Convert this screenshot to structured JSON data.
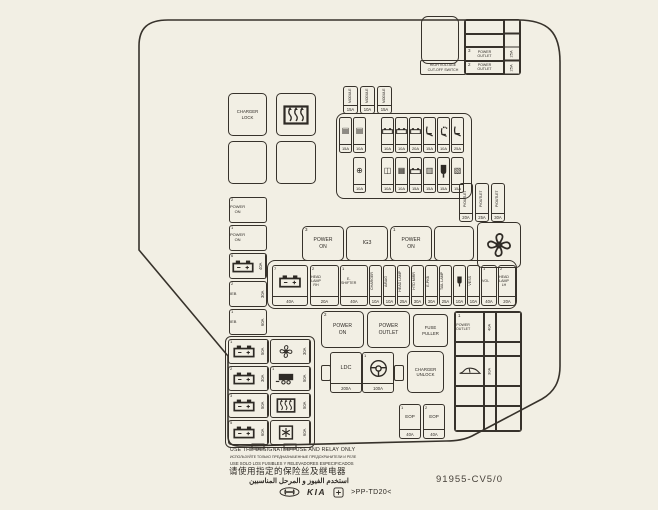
{
  "page": {
    "bg": "#f2efe4",
    "ink": "#2e2a25"
  },
  "hv_switch": {
    "label": "HIGH VOLTAGE\nCUT-OFF SWITCH"
  },
  "top_right_table": {
    "rows": [
      {
        "num": "",
        "label": "",
        "amp": ""
      },
      {
        "num": "",
        "label": "",
        "amp": ""
      },
      {
        "num": "3",
        "label": "POWER\nOUTLET",
        "amp": "25A"
      },
      {
        "num": "2",
        "label": "POWER\nOUTLET",
        "amp": "25A"
      }
    ]
  },
  "boxes": {
    "charger_lock": "CHARGER\nLOCK",
    "power_on_3": {
      "num": "3",
      "label": "POWER\nON"
    },
    "ig3": "IG3",
    "power_on_1": {
      "num": "1",
      "label": "POWER\nON"
    },
    "power_on_2": {
      "num": "2",
      "label": "POWER\nON"
    },
    "power_outlet": "POWER\nOUTLET",
    "fuse_puller": "FUSE\nPULLER",
    "charger_unlock": "CHARGER\nUNLOCK",
    "ldc": {
      "label": "LDC",
      "amp": "200A"
    },
    "steering": {
      "num": "1",
      "amp": "100A"
    }
  },
  "top_trio": [
    {
      "label": "MODULE",
      "amp": "15A"
    },
    {
      "label": "MODULE",
      "amp": "10A"
    },
    {
      "label": "MODULE",
      "amp": "15A"
    }
  ],
  "grid_row_a": [
    {
      "icon": "module",
      "amp": "15A"
    },
    {
      "icon": "module",
      "amp": "10A"
    },
    {
      "cls": "blank"
    },
    {
      "icon": "battsm",
      "amp": "10A"
    },
    {
      "icon": "battsm",
      "amp": "10A"
    },
    {
      "icon": "battsm",
      "amp": "20A"
    },
    {
      "icon": "seat",
      "amp": "15A"
    },
    {
      "icon": "seatfan",
      "amp": "10A"
    },
    {
      "icon": "seat",
      "amp": "25A"
    }
  ],
  "grid_row_b": [
    {
      "cls": "blank"
    },
    {
      "icon": "sensor",
      "amp": "10A"
    },
    {
      "cls": "blank"
    },
    {
      "icon": "mirror",
      "amp": "10A"
    },
    {
      "icon": "grid",
      "amp": "10A"
    },
    {
      "icon": "battsm",
      "amp": "15A"
    },
    {
      "icon": "key",
      "amp": "15A"
    },
    {
      "icon": "plug",
      "amp": "15A"
    },
    {
      "icon": "coil",
      "amp": "15A"
    }
  ],
  "right_trio": [
    {
      "label": "P/OUTLET",
      "amp": "20A"
    },
    {
      "label": "P/OUTLET",
      "amp": "25A"
    },
    {
      "label": "P/OUTLET",
      "amp": "30A"
    }
  ],
  "mid_row": [
    {
      "cls": "wide",
      "num": "7",
      "icon": "batt",
      "amp": "40A",
      "x": 4,
      "y": 4,
      "w": 36,
      "h": 41
    },
    {
      "cls": "wide",
      "num": "2",
      "label": "HEAD\nLAMP\nRH",
      "amp": "20A",
      "x": 42,
      "y": 4,
      "w": 29,
      "h": 41
    },
    {
      "cls": "wide",
      "num": "1",
      "label": "E-\nSHIFTER",
      "amp": "40A",
      "x": 72,
      "y": 4,
      "w": 28,
      "h": 41
    },
    {
      "cls": "narrow",
      "label": "CHARGER",
      "amp": "10A",
      "x": 101,
      "y": 4,
      "w": 13,
      "h": 41
    },
    {
      "cls": "narrow",
      "label": "A/BAG",
      "amp": "10A",
      "x": 115,
      "y": 4,
      "w": 13,
      "h": 41
    },
    {
      "cls": "narrow",
      "label": "HEAD LAMP",
      "amp": "25A",
      "x": 129,
      "y": 4,
      "w": 13,
      "h": 41
    },
    {
      "cls": "narrow",
      "label": "HTD MIRR",
      "amp": "30A",
      "x": 143,
      "y": 4,
      "w": 13,
      "h": 41
    },
    {
      "cls": "narrow",
      "label": "E-PKB",
      "amp": "30A",
      "x": 157,
      "y": 4,
      "w": 13,
      "h": 41
    },
    {
      "cls": "narrow",
      "label": "TAIL LAMP",
      "amp": "25A",
      "x": 171,
      "y": 4,
      "w": 13,
      "h": 41
    },
    {
      "cls": "narrow",
      "icon": "plug",
      "amp": "10A",
      "x": 185,
      "y": 4,
      "w": 13,
      "h": 41
    },
    {
      "cls": "narrow",
      "label": "VESS",
      "amp": "10A",
      "x": 199,
      "y": 4,
      "w": 13,
      "h": 41
    },
    {
      "cls": "wide",
      "num": "1",
      "label": "VOL",
      "amp": "40A",
      "x": 213,
      "y": 4,
      "w": 16,
      "h": 41
    },
    {
      "cls": "wide",
      "num": "2",
      "label": "HEAD\nLAMP\nLH",
      "amp": "20A",
      "x": 230,
      "y": 4,
      "w": 18,
      "h": 41
    }
  ],
  "left_strip": [
    {
      "num": "2",
      "label": "POWER\nON",
      "amp": "40A"
    },
    {
      "num": "1",
      "label": "POWER\nON",
      "amp": "40A"
    },
    {
      "num": "6",
      "icon": "batt",
      "amp": "40A"
    },
    {
      "num": "2",
      "label": "IEB",
      "amp": "30A"
    },
    {
      "num": "1",
      "label": "IEB",
      "amp": "60A"
    }
  ],
  "left_grid": [
    {
      "num": "1",
      "icon": "batt",
      "amp": "50A",
      "x": 2,
      "y": 2
    },
    {
      "icon": "fan",
      "amp": "30A",
      "x": 44,
      "y": 2
    },
    {
      "num": "2",
      "icon": "batt",
      "amp": "30A",
      "x": 2,
      "y": 29
    },
    {
      "num": "1",
      "icon": "trailer",
      "amp": "50A",
      "x": 44,
      "y": 29
    },
    {
      "num": "3",
      "icon": "batt",
      "amp": "50A",
      "x": 2,
      "y": 56
    },
    {
      "icon": "defrost",
      "amp": "50A",
      "x": 44,
      "y": 56
    },
    {
      "num": "5",
      "icon": "batt",
      "amp": "60A",
      "x": 2,
      "y": 83
    },
    {
      "icon": "snow",
      "amp": "60A",
      "x": 44,
      "y": 83
    }
  ],
  "right_table": {
    "rows": [
      {
        "num": "1",
        "label": "POWER\nOUTLET",
        "amp": "40A"
      },
      {
        "num": "",
        "label": "",
        "amp": ""
      },
      {
        "icon": "car",
        "amp": "30A"
      },
      {
        "num": "",
        "label": "",
        "amp": ""
      },
      {
        "num": "",
        "label": "",
        "amp": ""
      }
    ]
  },
  "eop": [
    {
      "cls": "wide",
      "num": "1",
      "label": "EOP",
      "amp": "40A",
      "w": 22,
      "h": 35
    },
    {
      "cls": "wide",
      "num": "2",
      "label": "EOP",
      "amp": "40A",
      "w": 22,
      "h": 35
    }
  ],
  "footer": {
    "en": "USE THE DESIGNATED FUSE AND RELAY ONLY",
    "ru": "ИСПОЛЬЗУЙТЕ ТОЛЬКО ПРЕДНАЗНАЧЕННЫЕ ПРЕДОХРАНИТЕЛИ И РЕЛЕ",
    "es": "USE SOLO LOS FUSIBLES Y RELEVADORES ESPECIFICADOS",
    "zh": "请使用指定的保险丝及继电器",
    "ar": "استخدم الفيوز و المرحل المناسبين",
    "kia": "KIA",
    "material": ">PP-TD20<",
    "part_number": "91955-CV5/0"
  }
}
